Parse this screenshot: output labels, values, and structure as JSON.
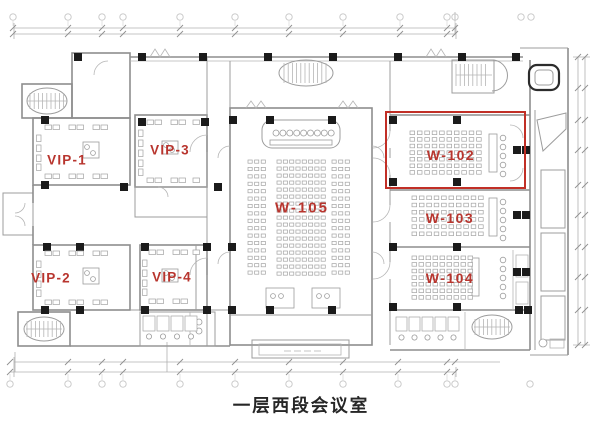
{
  "caption": "一层西段会议室",
  "rooms": [
    {
      "id": "vip-1",
      "label": "VIP-1"
    },
    {
      "id": "vip-2",
      "label": "VIP-2"
    },
    {
      "id": "vip-3",
      "label": "VIP-3"
    },
    {
      "id": "vip-4",
      "label": "VIP-4"
    },
    {
      "id": "w-102",
      "label": "W-102",
      "highlighted": true
    },
    {
      "id": "w-103",
      "label": "W-103"
    },
    {
      "id": "w-104",
      "label": "W-104"
    },
    {
      "id": "w-105",
      "label": "W-105"
    }
  ],
  "highlight": {
    "room": "W-102"
  },
  "colors": {
    "room_label": "#b8352e",
    "highlight_box": "#c12f26",
    "caption_text": "#262626",
    "plan_line": "#9c9c9c",
    "column": "#1b1b1b"
  }
}
